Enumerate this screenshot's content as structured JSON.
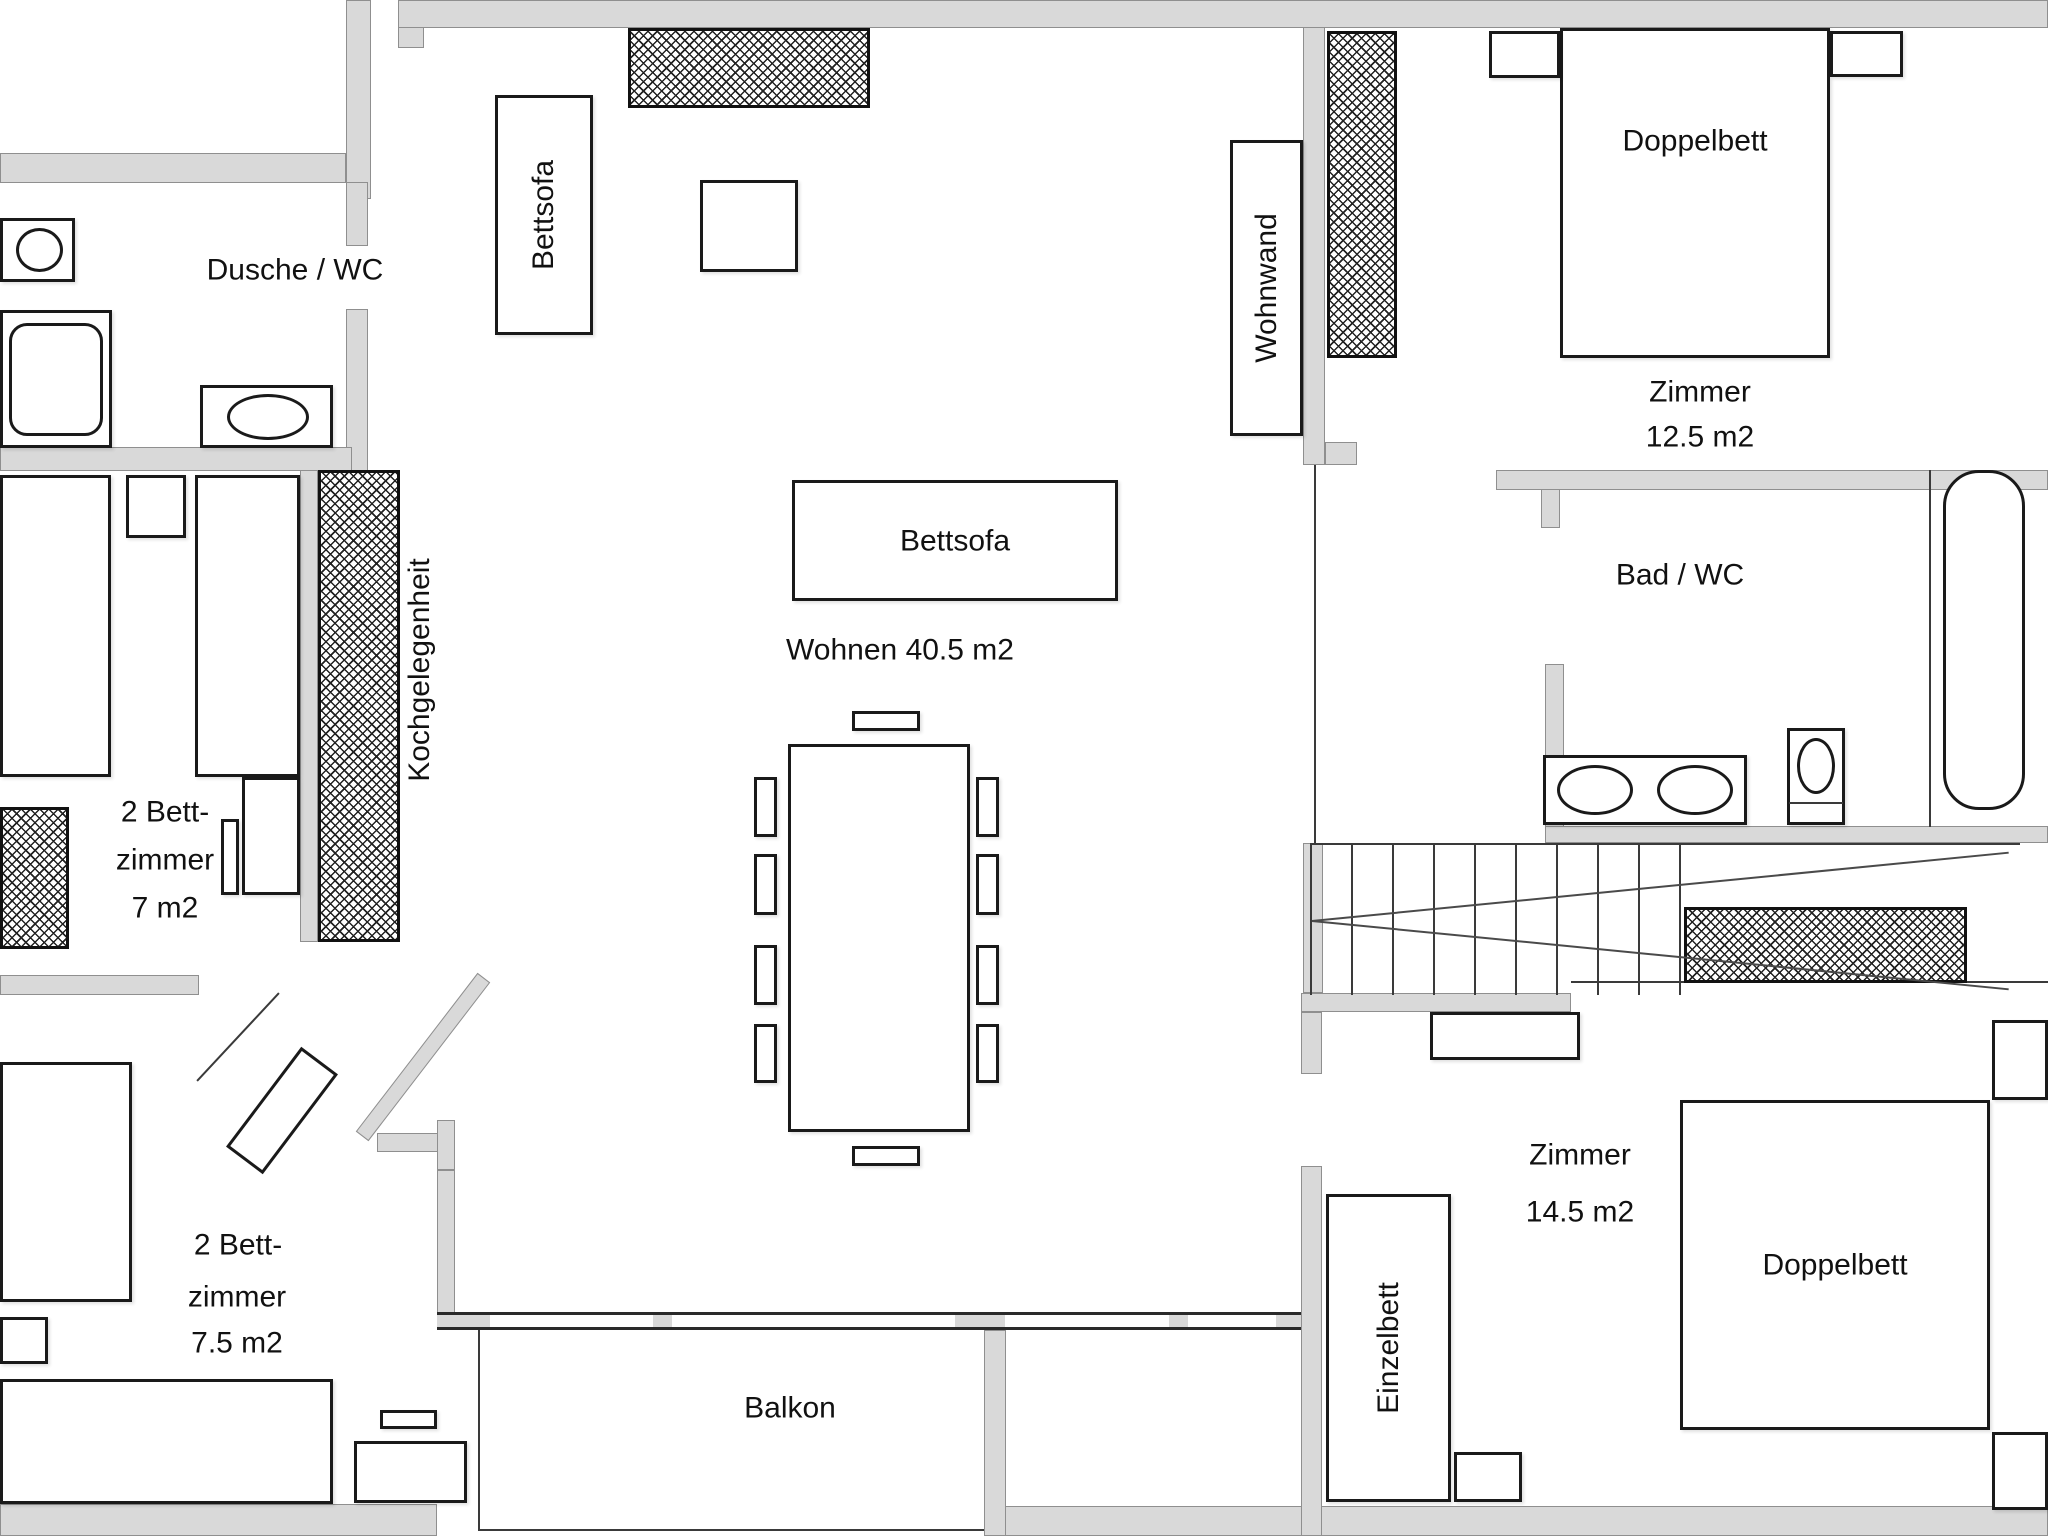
{
  "rooms": {
    "dusche_wc": {
      "label": "Dusche / WC"
    },
    "wohnen": {
      "label": "Wohnen 40.5 m2"
    },
    "kueche": {
      "label": "Kochgelegenheit"
    },
    "bett7": {
      "lines": [
        "2 Bett-",
        "zimmer",
        "7 m2"
      ]
    },
    "bett75": {
      "lines": [
        "2 Bett-",
        "zimmer",
        "7.5 m2"
      ]
    },
    "zimmer125": {
      "lines": [
        "Zimmer",
        "12.5 m2"
      ]
    },
    "zimmer145": {
      "lines": [
        "Zimmer",
        "14.5 m2"
      ]
    },
    "bad_wc": {
      "label": "Bad / WC"
    },
    "balkon": {
      "label": "Balkon"
    }
  },
  "furniture": {
    "bettsofa_vertical": {
      "label": "Bettsofa"
    },
    "bettsofa_horizontal": {
      "label": "Bettsofa"
    },
    "wohnwand": {
      "label": "Wohnwand"
    },
    "doppelbett_top": {
      "label": "Doppelbett"
    },
    "doppelbett_bottom": {
      "label": "Doppelbett"
    },
    "einzelbett": {
      "label": "Einzelbett"
    }
  },
  "colors": {
    "wall": "#d9d9d9",
    "outline": "#1a1a1a",
    "hatch_line": "#222222"
  }
}
